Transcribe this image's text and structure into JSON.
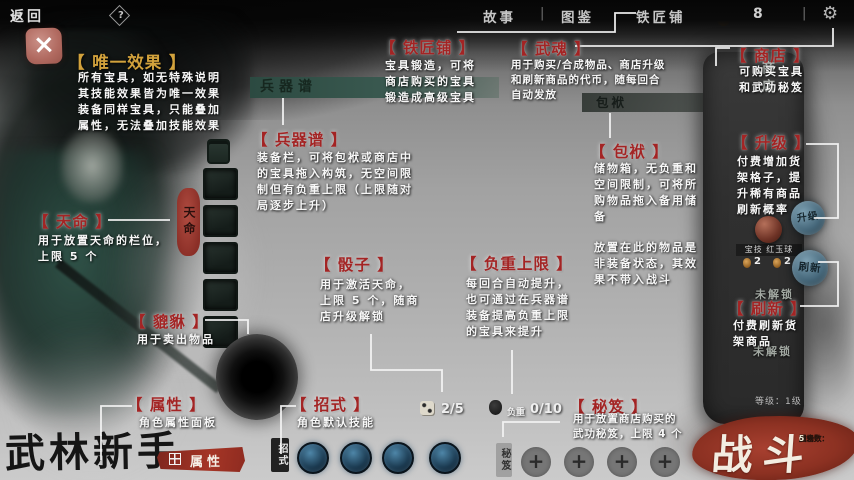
{
  "topbar": {
    "back": "返回",
    "nav": [
      "故事",
      "图鉴",
      "铁匠铺"
    ],
    "currency_count": "8"
  },
  "icons": {
    "back_arrow": "↩",
    "help": "?",
    "gear": "⚙",
    "close": "×",
    "plus": "+",
    "separator": "|"
  },
  "labels": {
    "unique": {
      "title": "【 唯一效果 】",
      "body": "所有宝具，如无特殊说明\n其技能效果皆为唯一效果\n装备同样宝具，只能叠加\n属性，无法叠加技能效果"
    },
    "blacksmith": {
      "title": "【 铁匠铺 】",
      "body": "宝具锻造，可将\n商店购买的宝具\n锻造成高级宝具"
    },
    "wuhun": {
      "title": "【 武魂 】",
      "body": "用于购买/合成物品、商店升级\n和刷新商品的代币，随每回合\n自动发放"
    },
    "shop": {
      "title": "【 商店 】",
      "body": "可购买宝具\n和武功秘笈"
    },
    "armory": {
      "title": "【 兵器谱 】",
      "body": "装备栏，可将包袱或商店中\n的宝具拖入构筑，无空间限\n制但有负重上限（上限随对\n局逐步上升）"
    },
    "bundle": {
      "title": "【 包袱 】",
      "body": "储物箱，无负重和\n空间限制，可将所\n购物品拖入备用储\n备",
      "body2": "放置在此的物品是\n非装备状态，其效\n果不带入战斗"
    },
    "upgrade": {
      "title": "【 升级 】",
      "body": "付费增加货\n架格子，提\n升稀有商品\n刷新概率"
    },
    "destiny": {
      "title": "【 天命 】",
      "body": "用于放置天命的栏位，\n上限 5 个"
    },
    "dice": {
      "title": "【 骰子 】",
      "body": "用于激活天命，\n上限 5 个，随商\n店升级解锁"
    },
    "weight": {
      "title": "【 负重上限 】",
      "body": "每回合自动提升，\n也可通过在兵器谱\n装备提高负重上限\n的宝具来提升"
    },
    "pixiu": {
      "title": "【 貔貅 】",
      "body": "用于卖出物品"
    },
    "refresh": {
      "title": "【 刷新 】",
      "body": "付费刷新货\n架商品"
    },
    "attributes": {
      "title": "【 属性 】",
      "body": "角色属性面板"
    },
    "moves": {
      "title": "【 招式 】",
      "body": "角色默认技能"
    },
    "manual": {
      "title": "【 秘笈 】",
      "body": "用于放置商店购买的\n武功秘笈，上限 4 个"
    }
  },
  "panels": {
    "armory_header": "兵器谱",
    "bundle_header": "包袱",
    "destiny_tab": "天命",
    "moves_tab": "招式",
    "manual_tab": "秘笈",
    "attributes_button": "属性"
  },
  "shop": {
    "vertical_title": "商店",
    "item_name": "宝技 红玉球",
    "item_costs": [
      "2",
      "2"
    ],
    "upgrade_seal": "升级",
    "refresh_seal": "刷新",
    "locked1": "未解锁",
    "locked2": "未解锁",
    "level": "等级：1级"
  },
  "counters": {
    "dice": "2/5",
    "weight_label": "负重",
    "weight": "0/10"
  },
  "footer": {
    "player_title": "武林新手",
    "battle": "战斗",
    "stats": [
      {
        "label": "回合数：",
        "value": "0"
      },
      {
        "label": "胜场数：",
        "value": "0"
      },
      {
        "label": "重来数：",
        "value": "5"
      }
    ]
  },
  "colors": {
    "label_red": "#a32424",
    "label_gold": "#d2a23c",
    "battle_red": "#9e3a2a",
    "header_teal": "#2e4f46"
  }
}
